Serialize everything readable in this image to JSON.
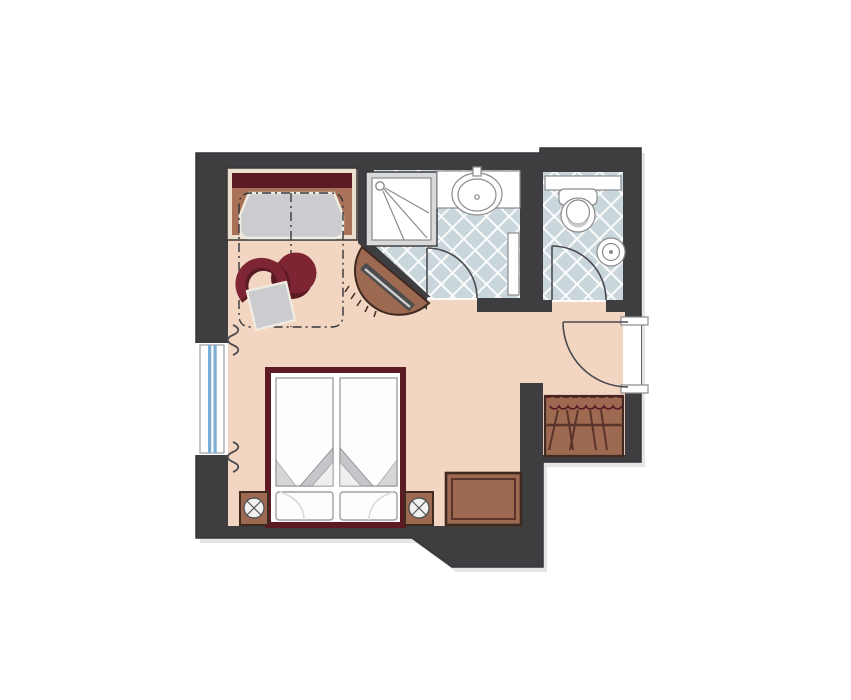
{
  "title": "Hotel guest room floor plan",
  "colors": {
    "wall": "#3e3e40",
    "outline_dark": "#35353a",
    "floor_main": "#f2d6c2",
    "tile_base": "#c9d6db",
    "tile_line": "#ffffff",
    "fixture_white": "#ffffff",
    "fixture_line": "#8a8a8e",
    "door_line": "#4a4a50",
    "furn_brown": "#9d6951",
    "furn_brown_dark": "#3f2a20",
    "furn_brown_line": "#5a332a",
    "maroon": "#7e2533",
    "maroon_dark": "#5a1a24",
    "bed_frame": "#5c1a23",
    "cushion": "#cbcbd0",
    "fold_gray": "#c6c6ca",
    "cream": "#ecdfcb",
    "cream_line": "#f0ece2",
    "tan": "#a87158",
    "window_blue": "#7aaed4",
    "tv_bar": "#4d4d4d",
    "tv_screen": "#cfcfcf"
  },
  "rooms": [
    {
      "id": "bedroom-living",
      "floor": "peach"
    },
    {
      "id": "shower-bathroom",
      "floor": "blue-tile"
    },
    {
      "id": "wc",
      "floor": "blue-tile"
    },
    {
      "id": "entry-hall",
      "floor": "peach"
    }
  ],
  "fixtures": [
    "daybed-sofa",
    "round-side-table",
    "armchair",
    "corner-tv-console",
    "double-bed",
    "nightstand-left",
    "nightstand-right",
    "luggage-bench",
    "wardrobe",
    "shower",
    "vanity-sink",
    "towel-radiator",
    "toilet",
    "wc-hand-basin",
    "window",
    "curtains",
    "bathroom-door",
    "wc-door",
    "entrance-door"
  ]
}
